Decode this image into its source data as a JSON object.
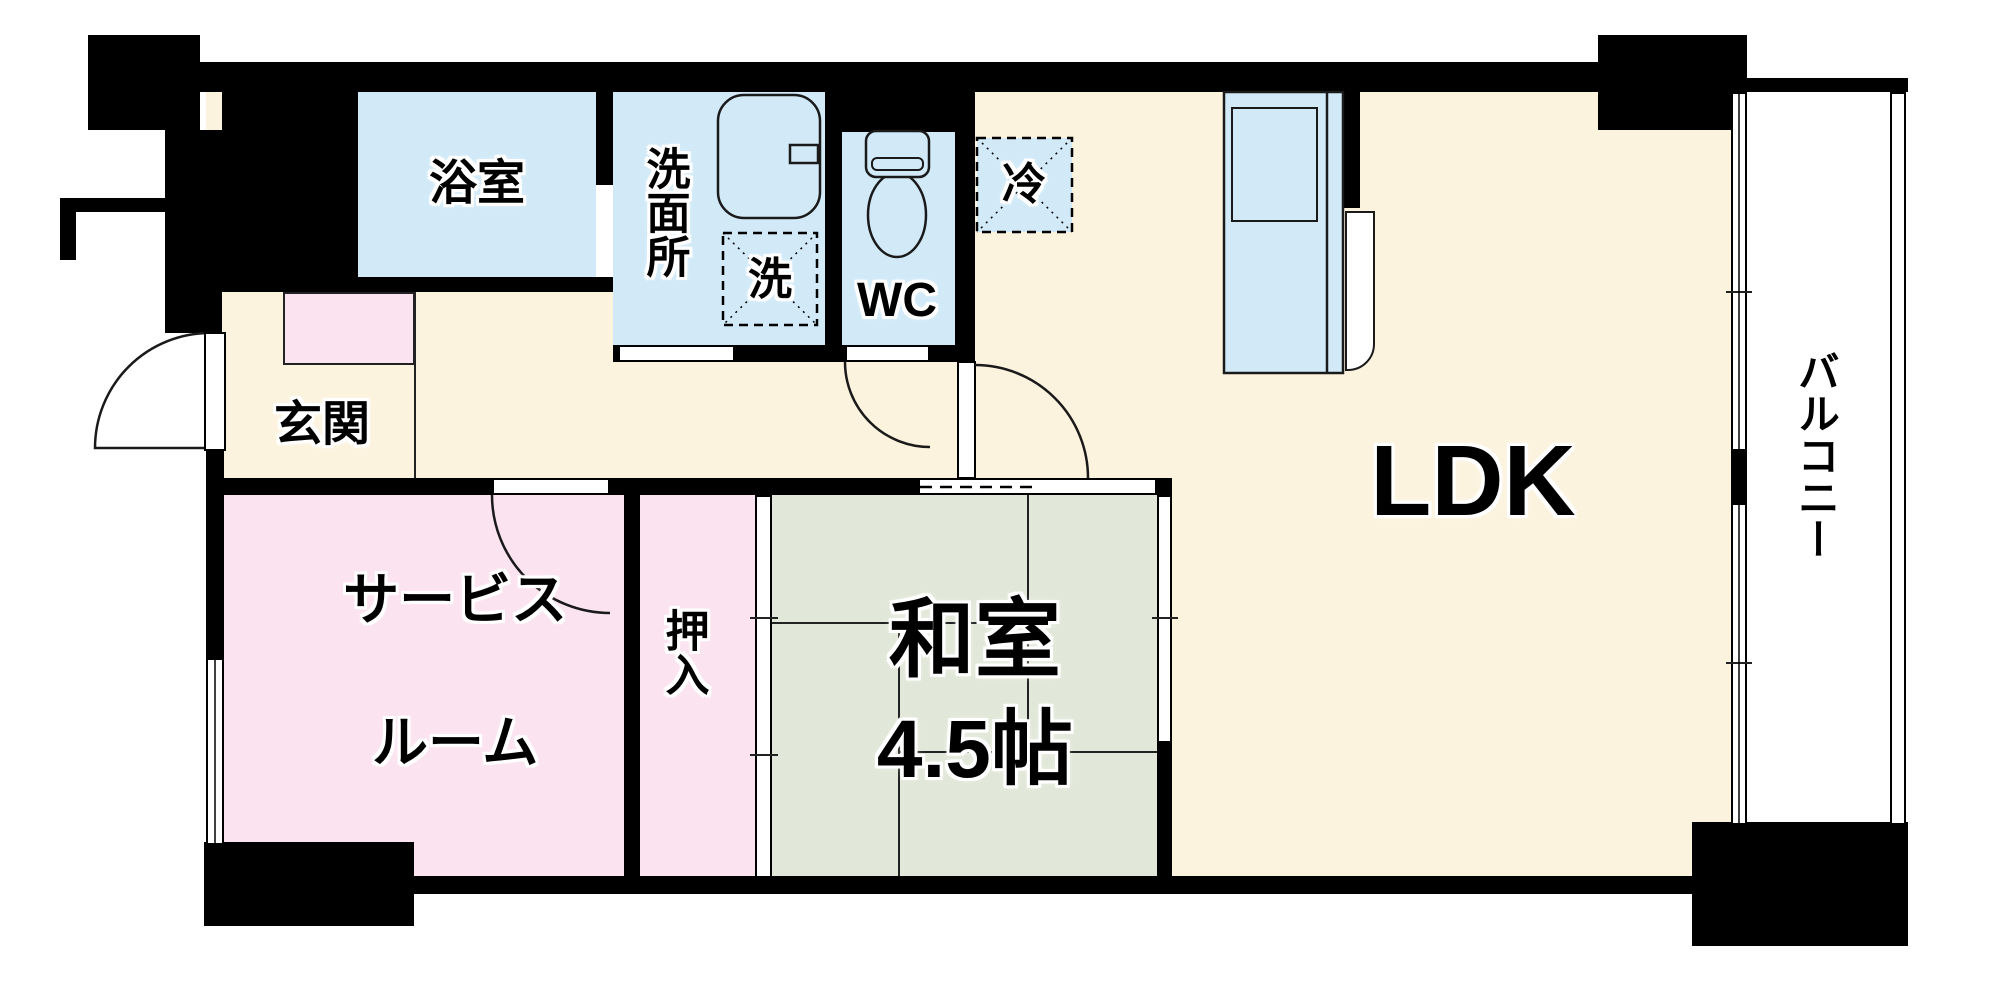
{
  "plan_type": "apartment-floor-plan",
  "rooms": {
    "bathroom": {
      "label": "浴室"
    },
    "washroom": {
      "label": "洗面所"
    },
    "laundry_box": {
      "label": "洗"
    },
    "toilet_room": {
      "label": "WC"
    },
    "refrigerator_box": {
      "label": "冷"
    },
    "entrance": {
      "label": "玄関"
    },
    "service_room": {
      "label_line1": "サービス",
      "label_line2": "ルーム"
    },
    "closet": {
      "label": "押入"
    },
    "japanese_room": {
      "label": "和室",
      "size": "4.5帖"
    },
    "ldk": {
      "label": "LDK"
    },
    "balcony": {
      "label": "バルコニー"
    }
  },
  "fixtures": [
    "vanity-basin-icon",
    "toilet-icon",
    "kitchen-counter",
    "entry-door",
    "service-room-door",
    "wc-door",
    "ldk-door",
    "kitchen-door",
    "washitsu-sliding-door",
    "oshiire-fusuma",
    "balcony-window",
    "balcony-railing"
  ],
  "colors": {
    "floor_cream": "#fcf3df",
    "water_blue": "#d2eaf8",
    "room_pink": "#fbe3ef",
    "tatami_green": "#e2e8d9",
    "wall_black": "#000000"
  }
}
